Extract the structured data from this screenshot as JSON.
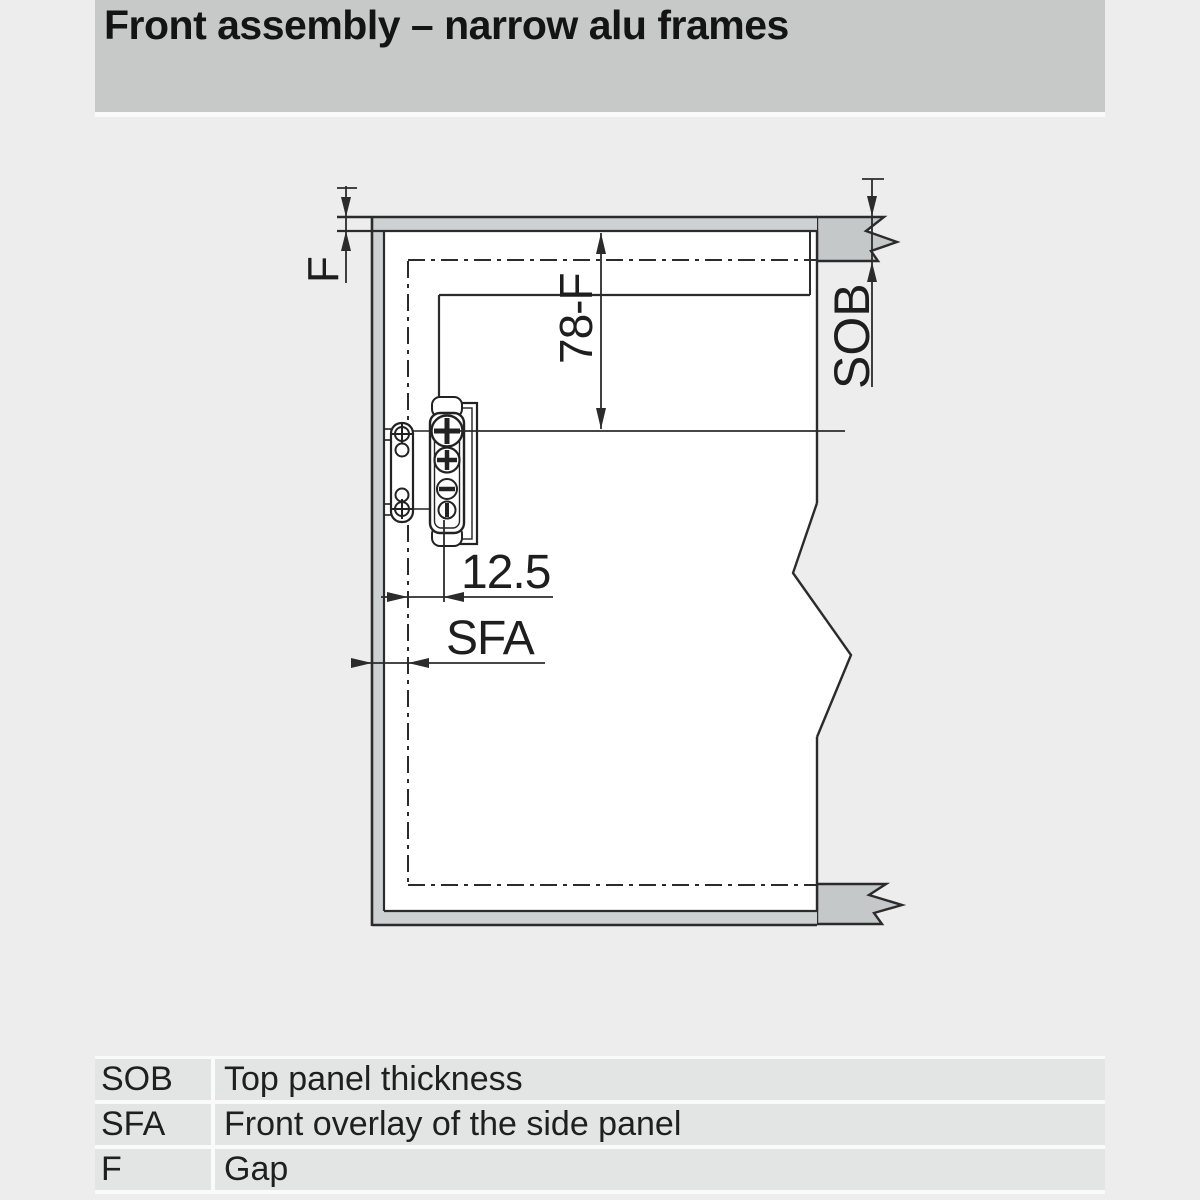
{
  "header": {
    "title": "Front assembly – narrow alu frames"
  },
  "diagram": {
    "labels": {
      "gap": "F",
      "top_offset": "78-F",
      "top_panel_thickness": "SOB",
      "hinge_distance": "12.5",
      "side_overlay": "SFA"
    },
    "colors": {
      "line": "#2b2b2b",
      "panel_fill": "#c5c8c9",
      "frame_fill": "#ced1d1",
      "front_fill": "#ffffff"
    }
  },
  "legend": {
    "rows": [
      {
        "abbr": "SOB",
        "desc": "Top panel thickness"
      },
      {
        "abbr": "SFA",
        "desc": "Front overlay of the side panel"
      },
      {
        "abbr": "F",
        "desc": "Gap"
      }
    ]
  }
}
